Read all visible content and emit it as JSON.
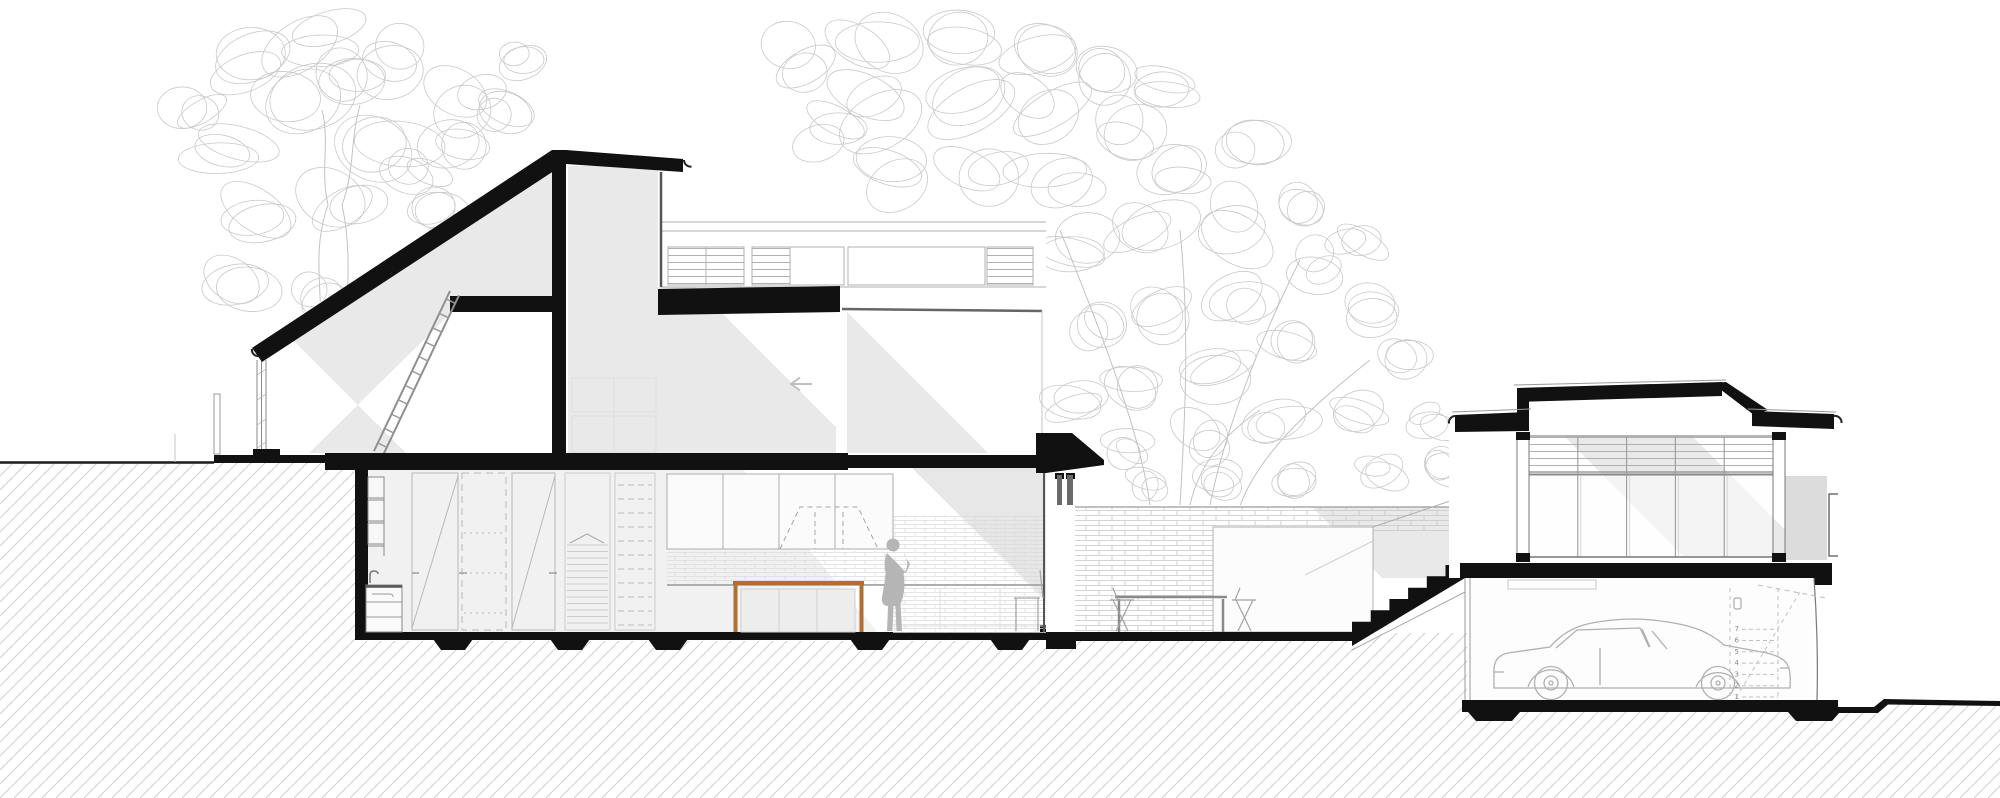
{
  "document": {
    "kind": "architectural-section-drawing",
    "description": "Black-and-white cut section through a two-storey house on a sloping site with a detached studio over a garage",
    "background": "#ffffff"
  },
  "palette": {
    "cut_poche_black": "#111111",
    "shadow_gray": "#e9e9e9",
    "interior_gray": "#f1f1f1",
    "tree_line_gray": "#c9c9c9",
    "earth_hatch_gray": "#cfcfcf",
    "brick_line_gray": "#c6c6c6",
    "thin_line_gray": "#9a9a9a",
    "figure_gray": "#b5b5b5",
    "car_line_gray": "#b0b0b0",
    "counter_wood_brown": "#b06f2e"
  },
  "annotations": {
    "garage_stair_tread_numbers": [
      "1",
      "2",
      "3",
      "4",
      "5",
      "6",
      "7"
    ],
    "interior_direction_arrow": "left"
  },
  "scene": {
    "left_house": [
      "mono-pitch-roof",
      "roof-monitor",
      "clerestory-band",
      "loft-floor",
      "loft-ladder",
      "bedroom-window",
      "upper-floor-slab",
      "ground-floor",
      "wall-shelf-ladder",
      "laundry-sink",
      "wardrobe-doors",
      "internal-stair",
      "pantry-shelves",
      "kitchen-upper-cabinets",
      "tiled-splashback",
      "range-hood",
      "kitchen-island",
      "person-figure",
      "glazed-end-wall",
      "entry-canopy"
    ],
    "courtyard": [
      "brick-garden-wall",
      "outdoor-dining-table",
      "dining-chairs",
      "glass-balustrade",
      "external-stair"
    ],
    "right_building": [
      "studio-roof",
      "louvre-window-band",
      "glazed-window-wall",
      "floor-slab",
      "garage",
      "car",
      "garage-stair",
      "ground-slab"
    ],
    "site": [
      "earth-hatch",
      "terrain-line-left",
      "terrain-line-right",
      "tree-left",
      "tree-right"
    ]
  },
  "figures": {
    "people": 1,
    "cars": 1
  }
}
